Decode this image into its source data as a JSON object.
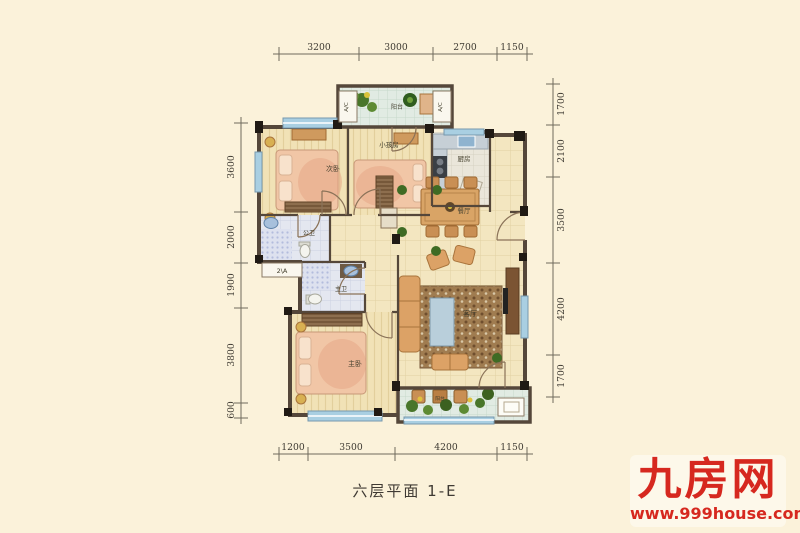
{
  "caption": "六层平面 1-E",
  "logo": {
    "brand": "九房网",
    "website": "www.999house.com"
  },
  "colors": {
    "brand_red": "#d6281f",
    "background": "#fbf2da",
    "wall": "#55473a"
  },
  "dimensions": {
    "top": [
      "3200",
      "3000",
      "2700",
      "1150"
    ],
    "bottom": [
      "1200",
      "3500",
      "4200",
      "1150"
    ],
    "left": [
      "3600",
      "2000",
      "1900",
      "3800",
      "600"
    ],
    "right": [
      "1700",
      "2100",
      "3500",
      "4200",
      "1700"
    ]
  },
  "rooms": {
    "balcony_top": "阳台",
    "ac_left": "A/C",
    "ac_right": "A/C",
    "bedroom2": "次卧",
    "kids_room": "小孩房",
    "kitchen": "厨房",
    "dining": "餐厅",
    "guest_bath": "公卫",
    "master_bath": "主卫",
    "master_bedroom": "主卧",
    "living_room": "客厅",
    "balcony_bottom": "阳台",
    "ac_platform_label": "2\\A"
  }
}
